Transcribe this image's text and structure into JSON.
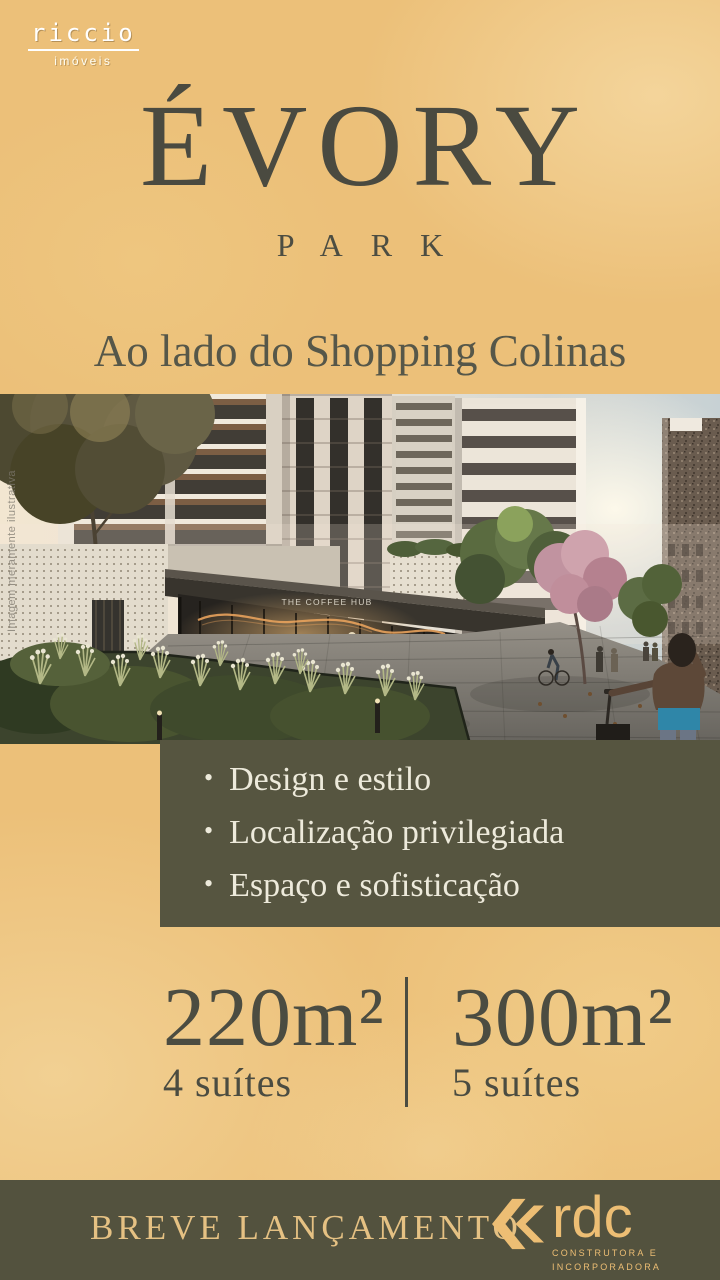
{
  "brand": {
    "name": "riccio",
    "tagline": "imóveis"
  },
  "title": {
    "main": "ÉVORY",
    "sub": "PARK"
  },
  "subtitle": "Ao lado do Shopping Colinas",
  "photo": {
    "watermark": "Imagem meramente ilustrativa",
    "cafe_sign": "THE COFFEE HUB"
  },
  "features": [
    "Design e estilo",
    "Localização privilegiada",
    "Espaço e sofisticação"
  ],
  "specs": [
    {
      "area": "220m²",
      "suites": "4 suítes"
    },
    {
      "area": "300m²",
      "suites": "5 suítes"
    }
  ],
  "footer": {
    "announcement": "BREVE LANÇAMENTO",
    "builder": {
      "name": "rdc",
      "tagline_line1": "CONSTRUTORA E",
      "tagline_line2": "INCORPORADORA"
    }
  },
  "colors": {
    "background": "#ecc079",
    "panel_olive": "#565540",
    "footer_olive": "#53523e",
    "text_dark": "#4a4a40",
    "text_cream": "#edeadb",
    "text_gold": "#e5c183",
    "logo_gold": "#edbe74"
  }
}
